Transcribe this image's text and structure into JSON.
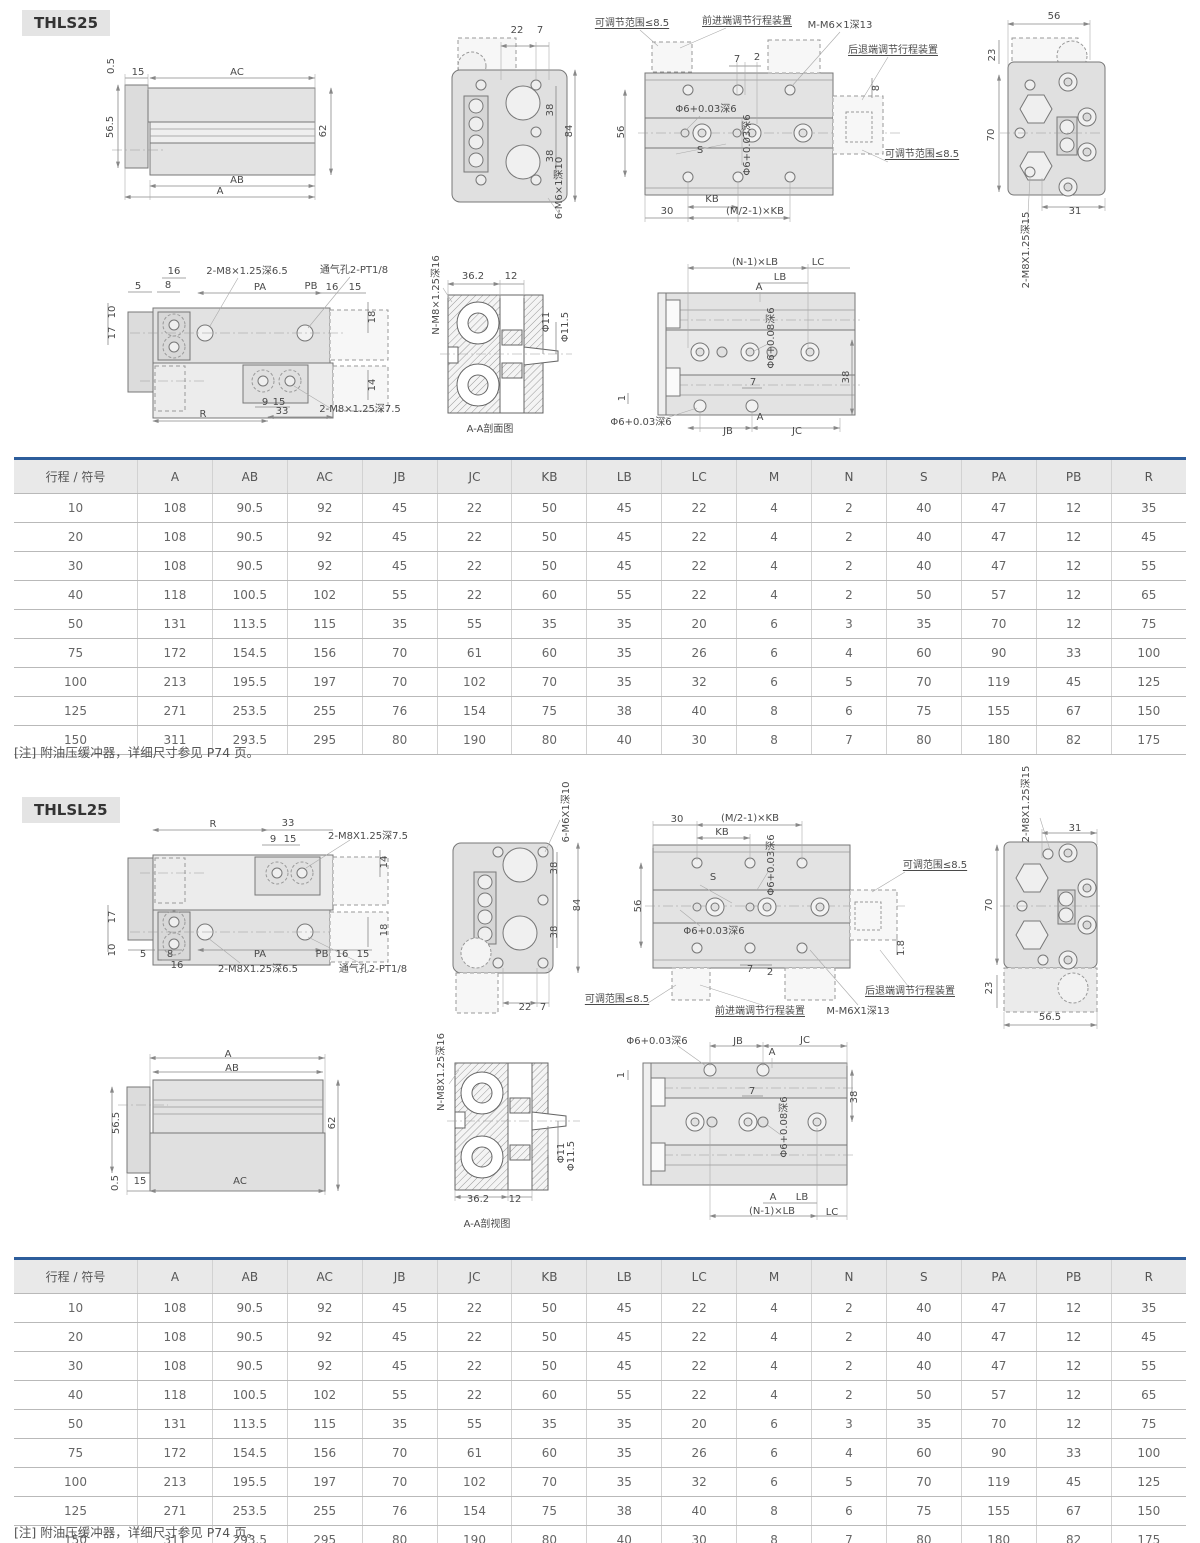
{
  "colors": {
    "accent_blue": "#2d5d9b",
    "table_header_bg": "#e9e9e9",
    "badge_bg": "#e4e4e4",
    "drawing_fill": "#e0e0e0"
  },
  "sections": [
    {
      "title": "THLS25",
      "note": "[注] 附油压缓冲器，详细尺寸参见 P74 页。"
    },
    {
      "title": "THLSL25",
      "note": "[注] 附油压缓冲器，详细尺寸参见 P74 页。"
    }
  ],
  "table": {
    "headers": [
      "行程 / 符号",
      "A",
      "AB",
      "AC",
      "JB",
      "JC",
      "KB",
      "LB",
      "LC",
      "M",
      "N",
      "S",
      "PA",
      "PB",
      "R"
    ],
    "rows": [
      [
        "10",
        "108",
        "90.5",
        "92",
        "45",
        "22",
        "50",
        "45",
        "22",
        "4",
        "2",
        "40",
        "47",
        "12",
        "35"
      ],
      [
        "20",
        "108",
        "90.5",
        "92",
        "45",
        "22",
        "50",
        "45",
        "22",
        "4",
        "2",
        "40",
        "47",
        "12",
        "45"
      ],
      [
        "30",
        "108",
        "90.5",
        "92",
        "45",
        "22",
        "50",
        "45",
        "22",
        "4",
        "2",
        "40",
        "47",
        "12",
        "55"
      ],
      [
        "40",
        "118",
        "100.5",
        "102",
        "55",
        "22",
        "60",
        "55",
        "22",
        "4",
        "2",
        "50",
        "57",
        "12",
        "65"
      ],
      [
        "50",
        "131",
        "113.5",
        "115",
        "35",
        "55",
        "35",
        "35",
        "20",
        "6",
        "3",
        "35",
        "70",
        "12",
        "75"
      ],
      [
        "75",
        "172",
        "154.5",
        "156",
        "70",
        "61",
        "60",
        "35",
        "26",
        "6",
        "4",
        "60",
        "90",
        "33",
        "100"
      ],
      [
        "100",
        "213",
        "195.5",
        "197",
        "70",
        "102",
        "70",
        "35",
        "32",
        "6",
        "5",
        "70",
        "119",
        "45",
        "125"
      ],
      [
        "125",
        "271",
        "253.5",
        "255",
        "76",
        "154",
        "75",
        "38",
        "40",
        "8",
        "6",
        "75",
        "155",
        "67",
        "150"
      ],
      [
        "150",
        "311",
        "293.5",
        "295",
        "80",
        "190",
        "80",
        "40",
        "30",
        "8",
        "7",
        "80",
        "180",
        "82",
        "175"
      ]
    ]
  },
  "drawings": {
    "s1_labels": [
      {
        "t": "0.5",
        "x": 112,
        "y": 66,
        "r": 1
      },
      {
        "t": "15",
        "x": 138,
        "y": 73
      },
      {
        "t": "AC",
        "x": 237,
        "y": 73
      },
      {
        "t": "56.5",
        "x": 111,
        "y": 127,
        "r": 1
      },
      {
        "t": "62",
        "x": 324,
        "y": 131,
        "r": 1
      },
      {
        "t": "AB",
        "x": 237,
        "y": 181
      },
      {
        "t": "A",
        "x": 220,
        "y": 192
      },
      {
        "t": "22",
        "x": 517,
        "y": 31
      },
      {
        "t": "7",
        "x": 540,
        "y": 31
      },
      {
        "t": "38",
        "x": 551,
        "y": 110,
        "r": 1
      },
      {
        "t": "84",
        "x": 570,
        "y": 131,
        "r": 1
      },
      {
        "t": "38",
        "x": 551,
        "y": 156,
        "r": 1
      },
      {
        "t": "6-M6×1深10",
        "x": 560,
        "y": 188,
        "r": 1
      },
      {
        "t": "可调节范围≤8.5",
        "x": 632,
        "y": 24,
        "u": 1
      },
      {
        "t": "前进端调节行程装置",
        "x": 747,
        "y": 22,
        "u": 1
      },
      {
        "t": "M-M6×1深13",
        "x": 840,
        "y": 26
      },
      {
        "t": "后退端调节行程装置",
        "x": 893,
        "y": 51,
        "u": 1
      },
      {
        "t": "7",
        "x": 737,
        "y": 60
      },
      {
        "t": "2",
        "x": 757,
        "y": 58
      },
      {
        "t": "Φ6+0.03深6",
        "x": 706,
        "y": 110
      },
      {
        "t": "56",
        "x": 622,
        "y": 132,
        "r": 1
      },
      {
        "t": "S",
        "x": 700,
        "y": 151
      },
      {
        "t": "8",
        "x": 877,
        "y": 88,
        "r": 1
      },
      {
        "t": "Φ6+0.03深6",
        "x": 748,
        "y": 145,
        "r": 1
      },
      {
        "t": "可调节范围≤8.5",
        "x": 922,
        "y": 155,
        "u": 1
      },
      {
        "t": "KB",
        "x": 712,
        "y": 200
      },
      {
        "t": "30",
        "x": 667,
        "y": 212
      },
      {
        "t": "(M/2-1)×KB",
        "x": 755,
        "y": 212
      },
      {
        "t": "56",
        "x": 1054,
        "y": 17
      },
      {
        "t": "23",
        "x": 993,
        "y": 55,
        "r": 1
      },
      {
        "t": "70",
        "x": 992,
        "y": 135,
        "r": 1
      },
      {
        "t": "31",
        "x": 1075,
        "y": 212
      },
      {
        "t": "2-M8X1.25深15",
        "x": 1027,
        "y": 250,
        "r": 1
      },
      {
        "t": "16",
        "x": 174,
        "y": 272
      },
      {
        "t": "2-M8×1.25深6.5",
        "x": 247,
        "y": 272
      },
      {
        "t": "通气孔2-PT1/8",
        "x": 354,
        "y": 271
      },
      {
        "t": "5",
        "x": 138,
        "y": 287
      },
      {
        "t": "8",
        "x": 168,
        "y": 286
      },
      {
        "t": "PA",
        "x": 260,
        "y": 288
      },
      {
        "t": "PB",
        "x": 311,
        "y": 287
      },
      {
        "t": "16",
        "x": 332,
        "y": 288
      },
      {
        "t": "15",
        "x": 355,
        "y": 288
      },
      {
        "t": "10",
        "x": 113,
        "y": 312,
        "r": 1
      },
      {
        "t": "17",
        "x": 113,
        "y": 333,
        "r": 1
      },
      {
        "t": "18",
        "x": 373,
        "y": 317,
        "r": 1
      },
      {
        "t": "14",
        "x": 373,
        "y": 385,
        "r": 1
      },
      {
        "t": "9",
        "x": 265,
        "y": 403
      },
      {
        "t": "15",
        "x": 279,
        "y": 403
      },
      {
        "t": "R",
        "x": 203,
        "y": 415
      },
      {
        "t": "33",
        "x": 282,
        "y": 412
      },
      {
        "t": "2-M8×1.25深7.5",
        "x": 360,
        "y": 410
      },
      {
        "t": "N-M8×1.25深16",
        "x": 437,
        "y": 295,
        "r": 1
      },
      {
        "t": "36.2",
        "x": 473,
        "y": 277
      },
      {
        "t": "12",
        "x": 511,
        "y": 277
      },
      {
        "t": "Φ11",
        "x": 547,
        "y": 322,
        "r": 1
      },
      {
        "t": "Φ11.5",
        "x": 566,
        "y": 327,
        "r": 1
      },
      {
        "t": "A-A剖面图",
        "x": 490,
        "y": 430
      },
      {
        "t": "(N-1)×LB",
        "x": 755,
        "y": 263
      },
      {
        "t": "LC",
        "x": 818,
        "y": 263
      },
      {
        "t": "LB",
        "x": 780,
        "y": 278
      },
      {
        "t": "A",
        "x": 759,
        "y": 288
      },
      {
        "t": "Φ6+0.08深6",
        "x": 772,
        "y": 338,
        "r": 1
      },
      {
        "t": "7",
        "x": 753,
        "y": 383
      },
      {
        "t": "38",
        "x": 847,
        "y": 377,
        "r": 1
      },
      {
        "t": "1",
        "x": 623,
        "y": 398,
        "r": 1
      },
      {
        "t": "Φ6+0.03深6",
        "x": 641,
        "y": 423
      },
      {
        "t": "JB",
        "x": 728,
        "y": 432
      },
      {
        "t": "A",
        "x": 760,
        "y": 418
      },
      {
        "t": "JC",
        "x": 797,
        "y": 432
      }
    ],
    "s2_labels": [
      {
        "t": "R",
        "x": 213,
        "y": 825
      },
      {
        "t": "33",
        "x": 288,
        "y": 824
      },
      {
        "t": "9",
        "x": 273,
        "y": 840
      },
      {
        "t": "15",
        "x": 290,
        "y": 840
      },
      {
        "t": "2-M8X1.25深7.5",
        "x": 368,
        "y": 837
      },
      {
        "t": "14",
        "x": 385,
        "y": 862,
        "r": 1
      },
      {
        "t": "17",
        "x": 113,
        "y": 917,
        "r": 1
      },
      {
        "t": "18",
        "x": 385,
        "y": 930,
        "r": 1
      },
      {
        "t": "10",
        "x": 113,
        "y": 950,
        "r": 1
      },
      {
        "t": "5",
        "x": 143,
        "y": 955
      },
      {
        "t": "8",
        "x": 170,
        "y": 955
      },
      {
        "t": "16",
        "x": 177,
        "y": 966
      },
      {
        "t": "PA",
        "x": 260,
        "y": 955
      },
      {
        "t": "PB",
        "x": 322,
        "y": 955
      },
      {
        "t": "16",
        "x": 342,
        "y": 955
      },
      {
        "t": "15",
        "x": 363,
        "y": 955
      },
      {
        "t": "2-M8X1.25深6.5",
        "x": 258,
        "y": 970
      },
      {
        "t": "通气孔2-PT1/8",
        "x": 373,
        "y": 970
      },
      {
        "t": "6-M6X1深10",
        "x": 567,
        "y": 812,
        "r": 1
      },
      {
        "t": "38",
        "x": 555,
        "y": 868,
        "r": 1
      },
      {
        "t": "84",
        "x": 578,
        "y": 905,
        "r": 1
      },
      {
        "t": "38",
        "x": 555,
        "y": 932,
        "r": 1
      },
      {
        "t": "22",
        "x": 525,
        "y": 1008
      },
      {
        "t": "7",
        "x": 543,
        "y": 1008
      },
      {
        "t": "可调范围≤8.5",
        "x": 617,
        "y": 1000,
        "u": 1
      },
      {
        "t": "30",
        "x": 677,
        "y": 820
      },
      {
        "t": "(M/2-1)×KB",
        "x": 750,
        "y": 819
      },
      {
        "t": "KB",
        "x": 722,
        "y": 833
      },
      {
        "t": "Φ6+0.03深6",
        "x": 772,
        "y": 865,
        "r": 1
      },
      {
        "t": "可调范围≤8.5",
        "x": 935,
        "y": 866,
        "u": 1
      },
      {
        "t": "56",
        "x": 639,
        "y": 906,
        "r": 1
      },
      {
        "t": "S",
        "x": 713,
        "y": 878
      },
      {
        "t": "Φ6+0.03深6",
        "x": 714,
        "y": 932
      },
      {
        "t": "70",
        "x": 990,
        "y": 905,
        "r": 1
      },
      {
        "t": "1.8",
        "x": 902,
        "y": 948,
        "r": 1
      },
      {
        "t": "7",
        "x": 750,
        "y": 970
      },
      {
        "t": "2",
        "x": 770,
        "y": 973
      },
      {
        "t": "23",
        "x": 990,
        "y": 988,
        "r": 1
      },
      {
        "t": "后退端调节行程装置",
        "x": 910,
        "y": 992,
        "u": 1
      },
      {
        "t": "前进端调节行程装置",
        "x": 760,
        "y": 1012,
        "u": 1
      },
      {
        "t": "M-M6X1深13",
        "x": 858,
        "y": 1012
      },
      {
        "t": "2-M8X1.25深15",
        "x": 1027,
        "y": 804,
        "r": 1
      },
      {
        "t": "31",
        "x": 1075,
        "y": 829
      },
      {
        "t": "56.5",
        "x": 1050,
        "y": 1018
      },
      {
        "t": "A",
        "x": 228,
        "y": 1055
      },
      {
        "t": "AB",
        "x": 232,
        "y": 1069
      },
      {
        "t": "56.5",
        "x": 117,
        "y": 1123,
        "r": 1
      },
      {
        "t": "62",
        "x": 333,
        "y": 1123,
        "r": 1
      },
      {
        "t": "0.5",
        "x": 116,
        "y": 1183,
        "r": 1
      },
      {
        "t": "15",
        "x": 140,
        "y": 1182
      },
      {
        "t": "AC",
        "x": 240,
        "y": 1182
      },
      {
        "t": "N-M8X1.25深16",
        "x": 442,
        "y": 1072,
        "r": 1
      },
      {
        "t": "Φ11",
        "x": 562,
        "y": 1153,
        "r": 1
      },
      {
        "t": "Φ11.5",
        "x": 572,
        "y": 1156,
        "r": 1
      },
      {
        "t": "36.2",
        "x": 478,
        "y": 1200
      },
      {
        "t": "12",
        "x": 515,
        "y": 1200
      },
      {
        "t": "A-A剖视图",
        "x": 487,
        "y": 1225
      },
      {
        "t": "Φ6+0.03深6",
        "x": 657,
        "y": 1042
      },
      {
        "t": "JB",
        "x": 738,
        "y": 1042
      },
      {
        "t": "JC",
        "x": 805,
        "y": 1041
      },
      {
        "t": "A",
        "x": 772,
        "y": 1053
      },
      {
        "t": "7",
        "x": 752,
        "y": 1092
      },
      {
        "t": "38",
        "x": 855,
        "y": 1097,
        "r": 1
      },
      {
        "t": "Φ6+0.08深6",
        "x": 785,
        "y": 1127,
        "r": 1
      },
      {
        "t": "1",
        "x": 622,
        "y": 1075,
        "r": 1
      },
      {
        "t": "A",
        "x": 773,
        "y": 1198
      },
      {
        "t": "LB",
        "x": 802,
        "y": 1198
      },
      {
        "t": "(N-1)×LB",
        "x": 772,
        "y": 1212
      },
      {
        "t": "LC",
        "x": 832,
        "y": 1213
      }
    ]
  }
}
